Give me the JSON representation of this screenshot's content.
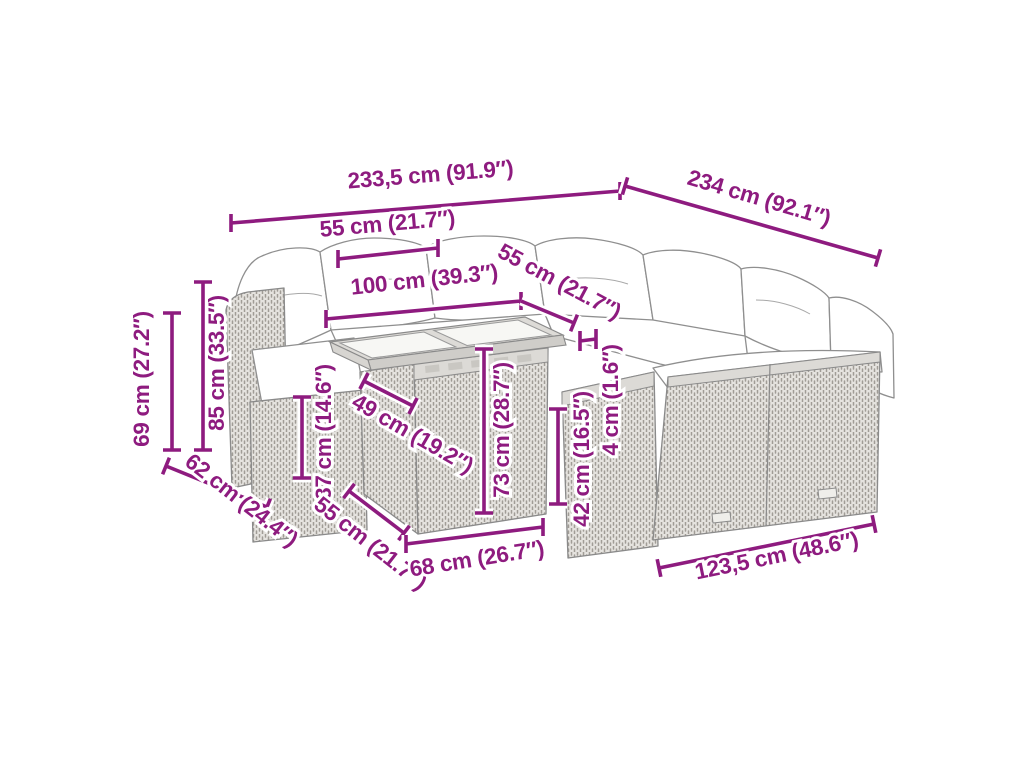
{
  "diagram": {
    "description": "Poly rattan garden lounge set with glass-top table — product dimension line drawing",
    "background_color": "#ffffff",
    "accent_color": "#8e1b7f",
    "line_art_color": "#8f8f8f",
    "cushion_color": "#ffffff",
    "rattan_fill_color": "#e5e3df"
  },
  "dimensions": [
    {
      "id": "overall-width-left-edge",
      "label": "233,5 cm (91.9″)"
    },
    {
      "id": "overall-width-right-edge",
      "label": "234 cm (92.1″)"
    },
    {
      "id": "seat-module-width",
      "label": "55 cm (21.7″)"
    },
    {
      "id": "table-top-length",
      "label": "100 cm (39.3″)"
    },
    {
      "id": "table-top-depth",
      "label": "55 cm (21.7″)"
    },
    {
      "id": "table-top-thickness",
      "label": "4 cm (1.6″)"
    },
    {
      "id": "backrest-height",
      "label": "85 cm (33.5″)"
    },
    {
      "id": "armrest-height",
      "label": "69 cm (27.2″)"
    },
    {
      "id": "side-depth",
      "label": "62 cm (24.4″)"
    },
    {
      "id": "seat-height",
      "label": "37 cm (14.6″)"
    },
    {
      "id": "seat-depth",
      "label": "49 cm (19.2″)"
    },
    {
      "id": "base-side-depth",
      "label": "55 cm (21.7″)"
    },
    {
      "id": "table-height",
      "label": "73 cm (28.7″)"
    },
    {
      "id": "table-base-width",
      "label": "68 cm (26.7″)"
    },
    {
      "id": "cushion-top-height",
      "label": "42 cm (16.5″)"
    },
    {
      "id": "right-sofa-length",
      "label": "123,5 cm (48.6″)"
    }
  ]
}
